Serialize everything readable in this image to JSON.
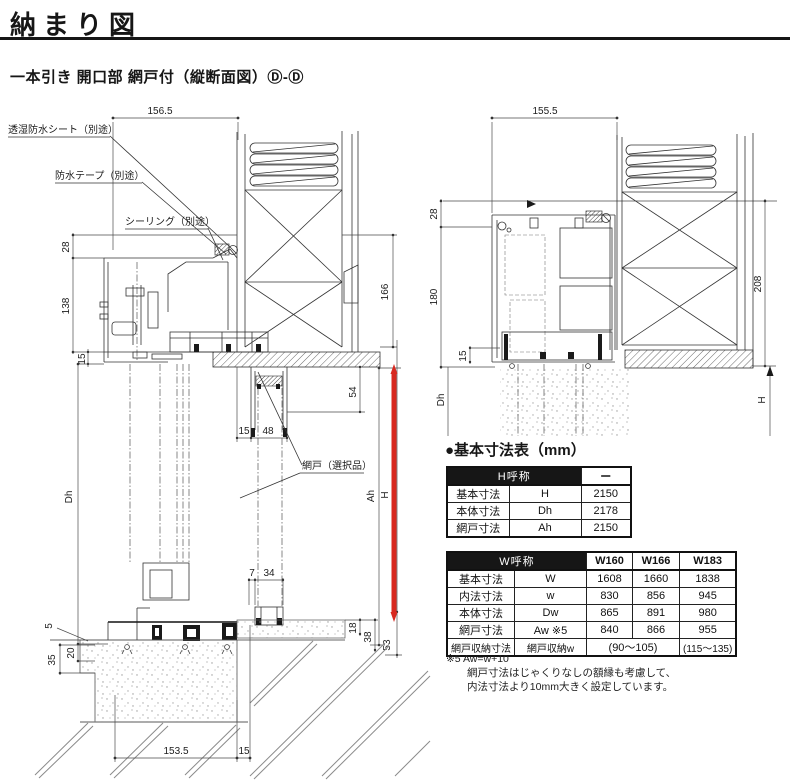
{
  "page": {
    "title": "納まり図",
    "subtitle": "一本引き 開口部 網戸付（縦断面図）Ⓓ-Ⓓ"
  },
  "colors": {
    "accent_red": "#d7281f",
    "line": "#333333"
  },
  "left_drawing": {
    "callouts": {
      "sheet": "透湿防水シート（別途）",
      "tape": "防水テープ（別途）",
      "sealing": "シーリング（別途）",
      "screen": "網戸（選択品）"
    },
    "dims": {
      "top_width": "156.5",
      "head_upper": "28",
      "head_lower": "138",
      "head_gap": "15",
      "body_height": "Dh",
      "sill_5": "5",
      "sill_20": "20",
      "sill_35": "35",
      "pocket_15": "15",
      "pocket_48": "48",
      "pocket_54": "54",
      "wall_166": "166",
      "screen_height": "Ah",
      "total_height": "H",
      "rail_7": "7",
      "rail_34": "34",
      "step_18": "18",
      "step_38": "38",
      "step_53": "53",
      "bottom_width": "153.5",
      "bottom_15": "15"
    }
  },
  "right_drawing": {
    "dims": {
      "top_width": "155.5",
      "head_upper": "28",
      "head_lower": "180",
      "sill_15": "15",
      "body_height": "Dh",
      "wall_208": "208",
      "total_height": "H"
    }
  },
  "spec": {
    "heading": "●基本寸法表（mm）",
    "h_table": {
      "header": "H呼称",
      "header_value": "ー",
      "rows": [
        {
          "name": "基本寸法",
          "symbol": "H",
          "value": "2150"
        },
        {
          "name": "本体寸法",
          "symbol": "Dh",
          "value": "2178"
        },
        {
          "name": "網戸寸法",
          "symbol": "Ah",
          "value": "2150"
        }
      ]
    },
    "w_table": {
      "header": "W呼称",
      "columns": [
        "W160",
        "W166",
        "W183"
      ],
      "rows": [
        {
          "name": "基本寸法",
          "symbol": "W",
          "v1": "1608",
          "v2": "1660",
          "v3": "1838"
        },
        {
          "name": "内法寸法",
          "symbol": "w",
          "v1": "830",
          "v2": "856",
          "v3": "945"
        },
        {
          "name": "本体寸法",
          "symbol": "Dw",
          "v1": "865",
          "v2": "891",
          "v3": "980"
        },
        {
          "name": "網戸寸法",
          "symbol": "Aw ※5",
          "v1": "840",
          "v2": "866",
          "v3": "955"
        }
      ],
      "storage_row": {
        "name": "網戸収納寸法",
        "symbol": "網戸収納w",
        "span_value": "(90〜105)",
        "last_value": "(115〜135)"
      }
    },
    "notes": [
      "※5 Aw=w+10",
      "網戸寸法はじゃくりなしの額縁も考慮して、",
      "内法寸法より10mm大きく設定しています。"
    ]
  }
}
